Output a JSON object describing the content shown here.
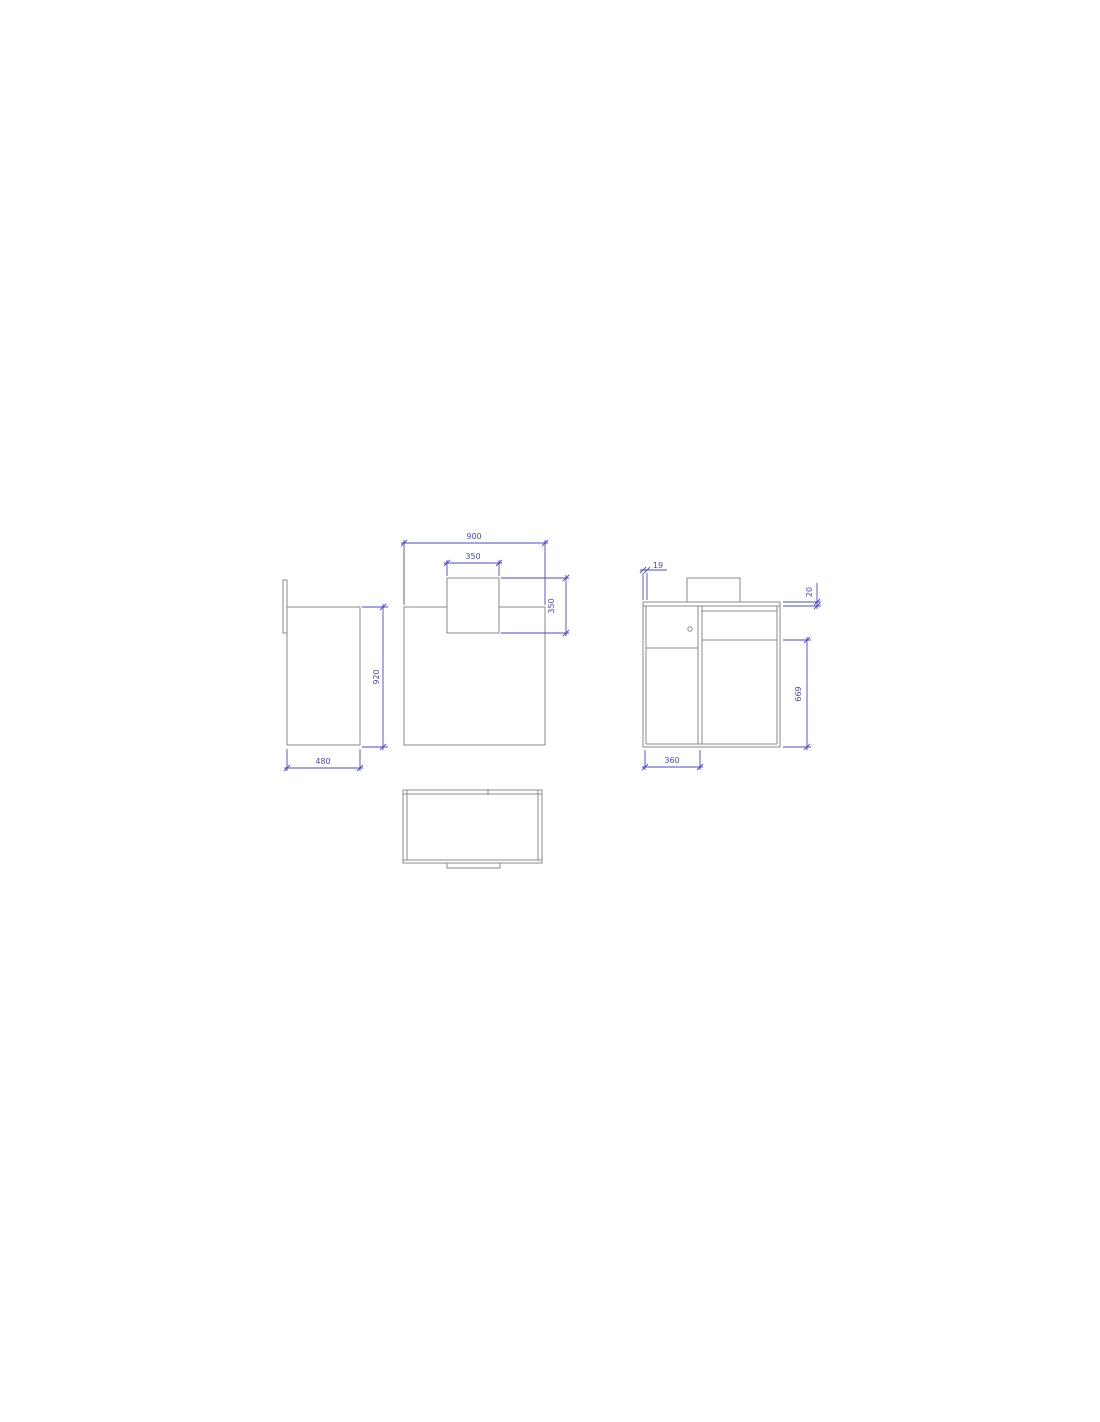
{
  "document": {
    "type": "furniture-technical-drawing",
    "description": "Orthographic projection drawing of a counter desk with raised top panel, drawer and doors",
    "background_color": "#ffffff",
    "object_line_color": "#8a8a8a",
    "dimension_color": "#4747cd"
  },
  "views": {
    "side": {
      "name": "side-view",
      "dimensions": {
        "height": "920",
        "depth": "480"
      }
    },
    "front": {
      "name": "front-view",
      "dimensions": {
        "width": "900",
        "panel_width": "350",
        "panel_height": "350"
      }
    },
    "back": {
      "name": "back-view",
      "dimensions": {
        "panel_thickness": "19",
        "top_thickness": "20",
        "door_height": "669",
        "drawer_width": "360"
      }
    },
    "top": {
      "name": "top-view"
    }
  }
}
